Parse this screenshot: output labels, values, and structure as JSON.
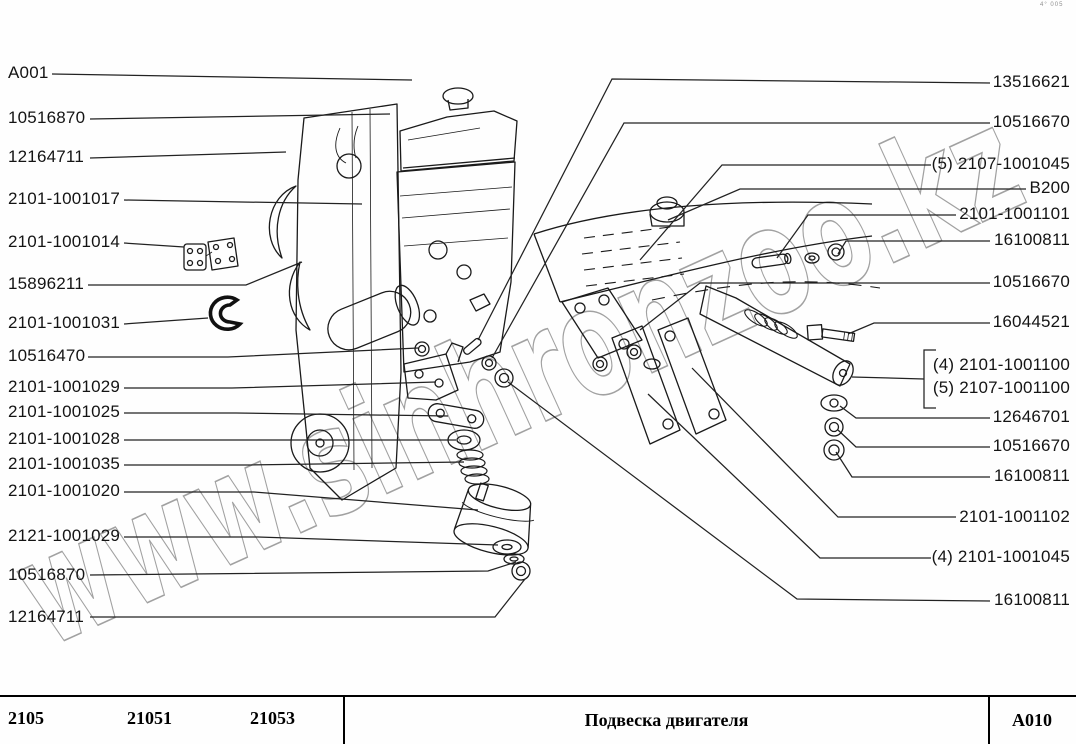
{
  "corner_mark": "4° 005",
  "watermark": "www.sinhronzoo.kz",
  "callouts": {
    "left": [
      {
        "label": "A001"
      },
      {
        "label": "10516870"
      },
      {
        "label": "12164711"
      },
      {
        "label": "2101-1001017"
      },
      {
        "label": "2101-1001014"
      },
      {
        "label": "15896211"
      },
      {
        "label": "2101-1001031"
      },
      {
        "label": "10516470"
      },
      {
        "label": "2101-1001029"
      },
      {
        "label": "2101-1001025"
      },
      {
        "label": "2101-1001028"
      },
      {
        "label": "2101-1001035"
      },
      {
        "label": "2101-1001020"
      },
      {
        "label": "2121-1001029"
      },
      {
        "label": "10516870"
      },
      {
        "label": "12164711"
      }
    ],
    "right": [
      {
        "label": "13516621"
      },
      {
        "label": "10516670"
      },
      {
        "label": "(5) 2107-1001045"
      },
      {
        "label": "B200"
      },
      {
        "label": "2101-1001101"
      },
      {
        "label": "16100811"
      },
      {
        "label": "10516670"
      },
      {
        "label": "16044521"
      },
      {
        "label": "(4) 2101-1001100"
      },
      {
        "label": "(5) 2107-1001100"
      },
      {
        "label": "12646701"
      },
      {
        "label": "10516670"
      },
      {
        "label": "16100811"
      },
      {
        "label": "2101-1001102"
      },
      {
        "label": "(4) 2101-1001045"
      },
      {
        "label": "16100811"
      }
    ]
  },
  "footer": {
    "models": [
      "2105",
      "21051",
      "21053"
    ],
    "title": "Подвеска двигателя",
    "code": "A010"
  }
}
